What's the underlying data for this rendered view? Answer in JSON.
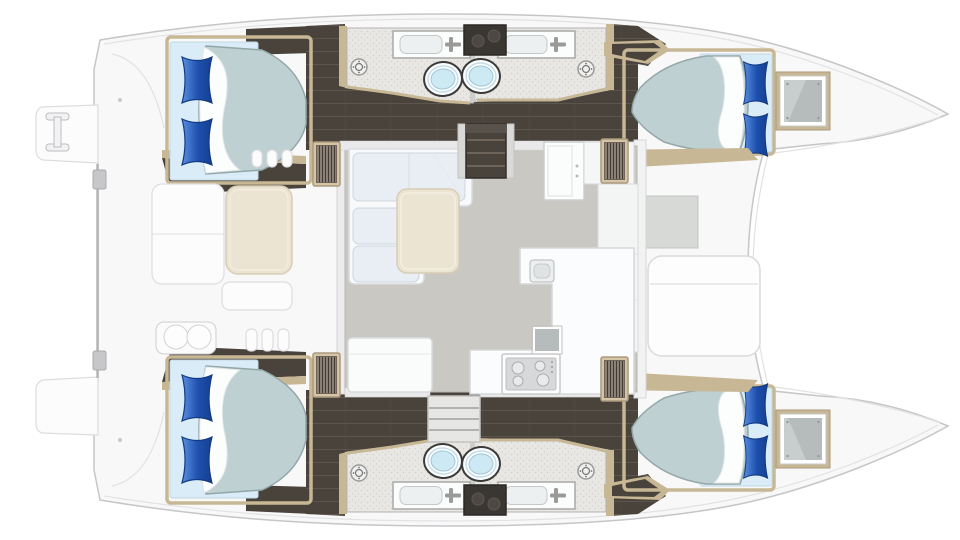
{
  "title": "Catamaran yacht floor plan — top view",
  "diagram_type": "boat-floor-plan",
  "palette": {
    "bg": "#ffffff",
    "hull": "#f8f8f9",
    "outline": "#c6c6c9",
    "seam": "#e2e2e4",
    "dark": "#49433c",
    "darkline": "#322e29",
    "wood": "#c8b795",
    "wood_light": "#d5c5a6",
    "bathfloor": "#e8e7e3",
    "salonfloor": "#cac8c3",
    "sofa": "#f7f9fa",
    "cushion": "#e8eef3",
    "table": "#ece4d3",
    "mattress": "#bed0d2",
    "mattressedge": "#93a7a9",
    "bedbase": "#d9ecf7",
    "sheet": "#fcfdfd",
    "pillow_light": "#5a8fe0",
    "pillow_dark": "#1d4fae",
    "toilet": "#cdeaf4",
    "recess": "#d7d9d7",
    "glass": "#b6bcbc"
  },
  "rooms": [
    {
      "id": "port-aft-cabin",
      "label": "Double cabin (port aft)"
    },
    {
      "id": "port-forward-cabin",
      "label": "Double cabin (port forward)"
    },
    {
      "id": "starboard-aft-cabin",
      "label": "Double cabin (starboard aft)"
    },
    {
      "id": "starboard-forward-cabin",
      "label": "Double cabin (starboard forward)"
    },
    {
      "id": "port-heads",
      "label": "Two bathrooms with toilet, sink and shower (port hull)"
    },
    {
      "id": "starboard-heads",
      "label": "Two bathrooms with toilet, sink and shower (starboard hull)"
    },
    {
      "id": "salon",
      "label": "Salon with L-sofa and table"
    },
    {
      "id": "galley",
      "label": "Galley with stove, sink and fridge"
    },
    {
      "id": "cockpit",
      "label": "Aft cockpit with table and bench seats"
    },
    {
      "id": "foredeck",
      "label": "Foredeck lounge"
    }
  ],
  "fixtures": {
    "double_beds": 4,
    "pillows": 8,
    "toilets": 4,
    "bathroom_sinks": 4,
    "shower_drains": 4,
    "companionway_stairs": 4,
    "stoves": 1,
    "galley_sinks": 1,
    "swim_platforms": 2
  }
}
